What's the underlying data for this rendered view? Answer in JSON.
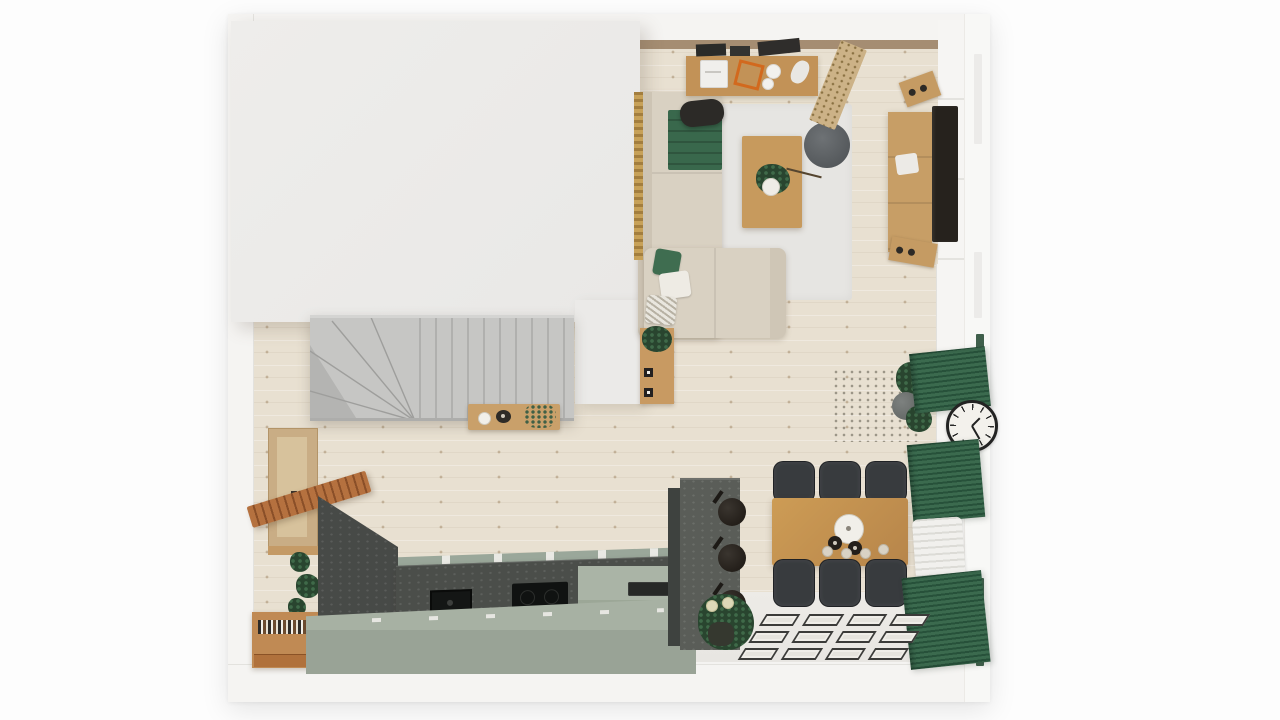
{
  "scene": {
    "type": "top-down 3D rendered floor plan",
    "rooms": [
      "living-room",
      "kitchen",
      "dining-area",
      "entry",
      "staircase-hall"
    ],
    "upper_floor_cutaway": true
  },
  "palette": {
    "page_background": "#fdfdfd",
    "wall_white": "#f5f4f2",
    "cover_block": "#ecebe9",
    "wood_floor": "#e8e0d1",
    "rug_gray": "#e6e5e2",
    "sofa_beige": "#d9d1c2",
    "accent_green": "#3f6d50",
    "curtain_green": "#33604a",
    "wood_furniture": "#c79a5d",
    "warm_wood_slats": "#b5713f",
    "kitchen_island_sage": "#9fab9e",
    "counter_dark_stone": "#4b4e4a",
    "stairs_gray": "#c6c6c4",
    "dining_chair_dark": "#383b3e",
    "appliance_black": "#141615"
  },
  "living_room": {
    "items": [
      "desk",
      "desk-chair",
      "printer",
      "orange-frame",
      "desk-lamp",
      "paper-rolls",
      "woven-runner",
      "corner-sofa",
      "green-blanket",
      "pillows",
      "area-rug",
      "coffee-table",
      "plant",
      "pouf",
      "tv-unit",
      "tv",
      "speakers",
      "side-cabinet"
    ]
  },
  "kitchen": {
    "items": [
      "dark-stone-counter",
      "sink",
      "cooktop",
      "sage-island",
      "tall-stone-column",
      "hanging-pans",
      "plant",
      "book-cabinet",
      "slatted-bench",
      "wall-niche"
    ],
    "hanging_pans": 3
  },
  "dining": {
    "items": [
      "wood-table",
      "chairs",
      "pendant-plate",
      "bottles",
      "place-settings"
    ],
    "chairs_per_side": 3,
    "sides": 2,
    "place_settings": 4
  },
  "right_wall": {
    "items": [
      "windows",
      "curtains",
      "wall-clock",
      "radiator",
      "potted-plant"
    ],
    "curtain_panels": 3
  },
  "entry_mat": {
    "rows": 3,
    "cols": 4,
    "tile_count": 12
  },
  "staircase": {
    "straight_treads": 10,
    "winder_treads": 4
  }
}
